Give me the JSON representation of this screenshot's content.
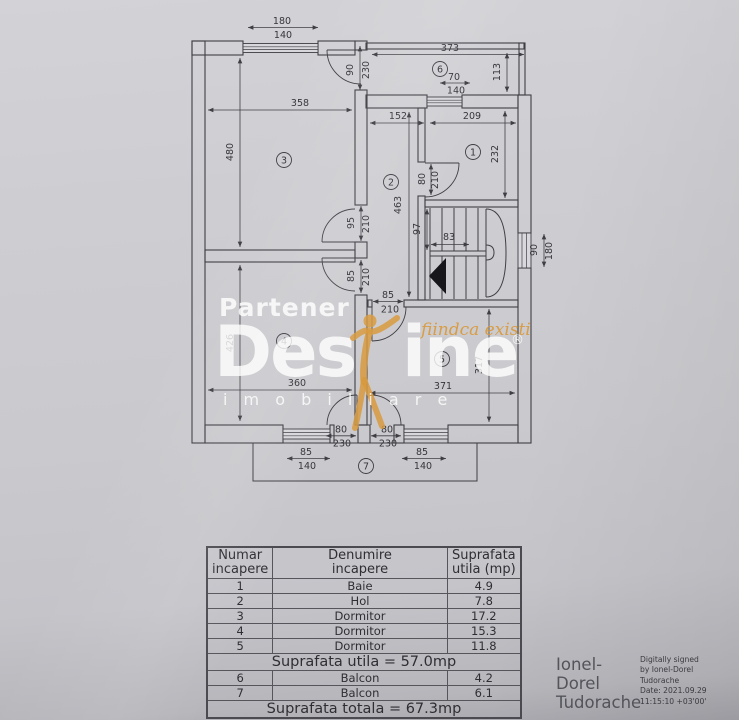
{
  "colors": {
    "paper": "#cbcbd0",
    "plan_line": "#3e3e44",
    "accent_orange": "#d89a3e",
    "watermark_white": "rgba(255,255,255,0.8)",
    "signature_gray": "#55555c"
  },
  "watermark": {
    "partener": "Partener",
    "brand_left": "Des",
    "brand_right": "ine",
    "registered": "®",
    "imobiliare": "i m o b i l i a r e",
    "slogan": "fiindca existi"
  },
  "plan": {
    "rooms": [
      "1",
      "2",
      "3",
      "4",
      "5",
      "6",
      "7"
    ],
    "dims": {
      "win_top": {
        "w": "180",
        "h": "140"
      },
      "balcony6": {
        "w": "373",
        "h": "113"
      },
      "door_balcony6": {
        "w": "90",
        "h": "230"
      },
      "win_bath": {
        "w": "70",
        "h": "140"
      },
      "room3": {
        "w": "358",
        "h": "480"
      },
      "hall": {
        "w": "152",
        "h": "463"
      },
      "room1": {
        "w": "209",
        "h": "232"
      },
      "door_room1": {
        "w": "80",
        "h": "210"
      },
      "door_room3": {
        "w": "95",
        "h": "210"
      },
      "stair_width": "97",
      "stair_tread": "83",
      "win_stair": {
        "w": "90",
        "h": "180"
      },
      "door_room4": {
        "w": "85",
        "h": "210"
      },
      "door_room5": {
        "w": "85",
        "h": "210"
      },
      "room4": {
        "w": "360",
        "h": "426"
      },
      "room5": {
        "w": "371",
        "h": "317"
      },
      "door_balc4": {
        "w": "80",
        "h": "230"
      },
      "door_balc5": {
        "w": "80",
        "h": "230"
      },
      "win_balc4": {
        "w": "85",
        "h": "140"
      },
      "win_balc5": {
        "w": "85",
        "h": "140"
      }
    }
  },
  "table": {
    "col1": {
      "l1": "Numar",
      "l2": "incapere"
    },
    "col2": {
      "l1": "Denumire",
      "l2": "incapere"
    },
    "col3": {
      "l1": "Suprafata",
      "l2": "utila (mp)"
    },
    "rows": [
      {
        "nr": "1",
        "name": "Baie",
        "area": "4.9"
      },
      {
        "nr": "2",
        "name": "Hol",
        "area": "7.8"
      },
      {
        "nr": "3",
        "name": "Dormitor",
        "area": "17.2"
      },
      {
        "nr": "4",
        "name": "Dormitor",
        "area": "15.3"
      },
      {
        "nr": "5",
        "name": "Dormitor",
        "area": "11.8"
      }
    ],
    "subtotal_label": "Suprafata utila = 57.0mp",
    "balcony_rows": [
      {
        "nr": "6",
        "name": "Balcon",
        "area": "4.2"
      },
      {
        "nr": "7",
        "name": "Balcon",
        "area": "6.1"
      }
    ],
    "total_label": "Suprafata totala = 67.3mp"
  },
  "signature": {
    "name_l1": "Ionel-",
    "name_l2": "Dorel",
    "name_l3": "Tudorache",
    "d1": "Digitally signed",
    "d2": "by Ionel-Dorel",
    "d3": "Tudorache",
    "d4": "Date: 2021.09.29",
    "d5": "11:15:10 +03'00'"
  }
}
